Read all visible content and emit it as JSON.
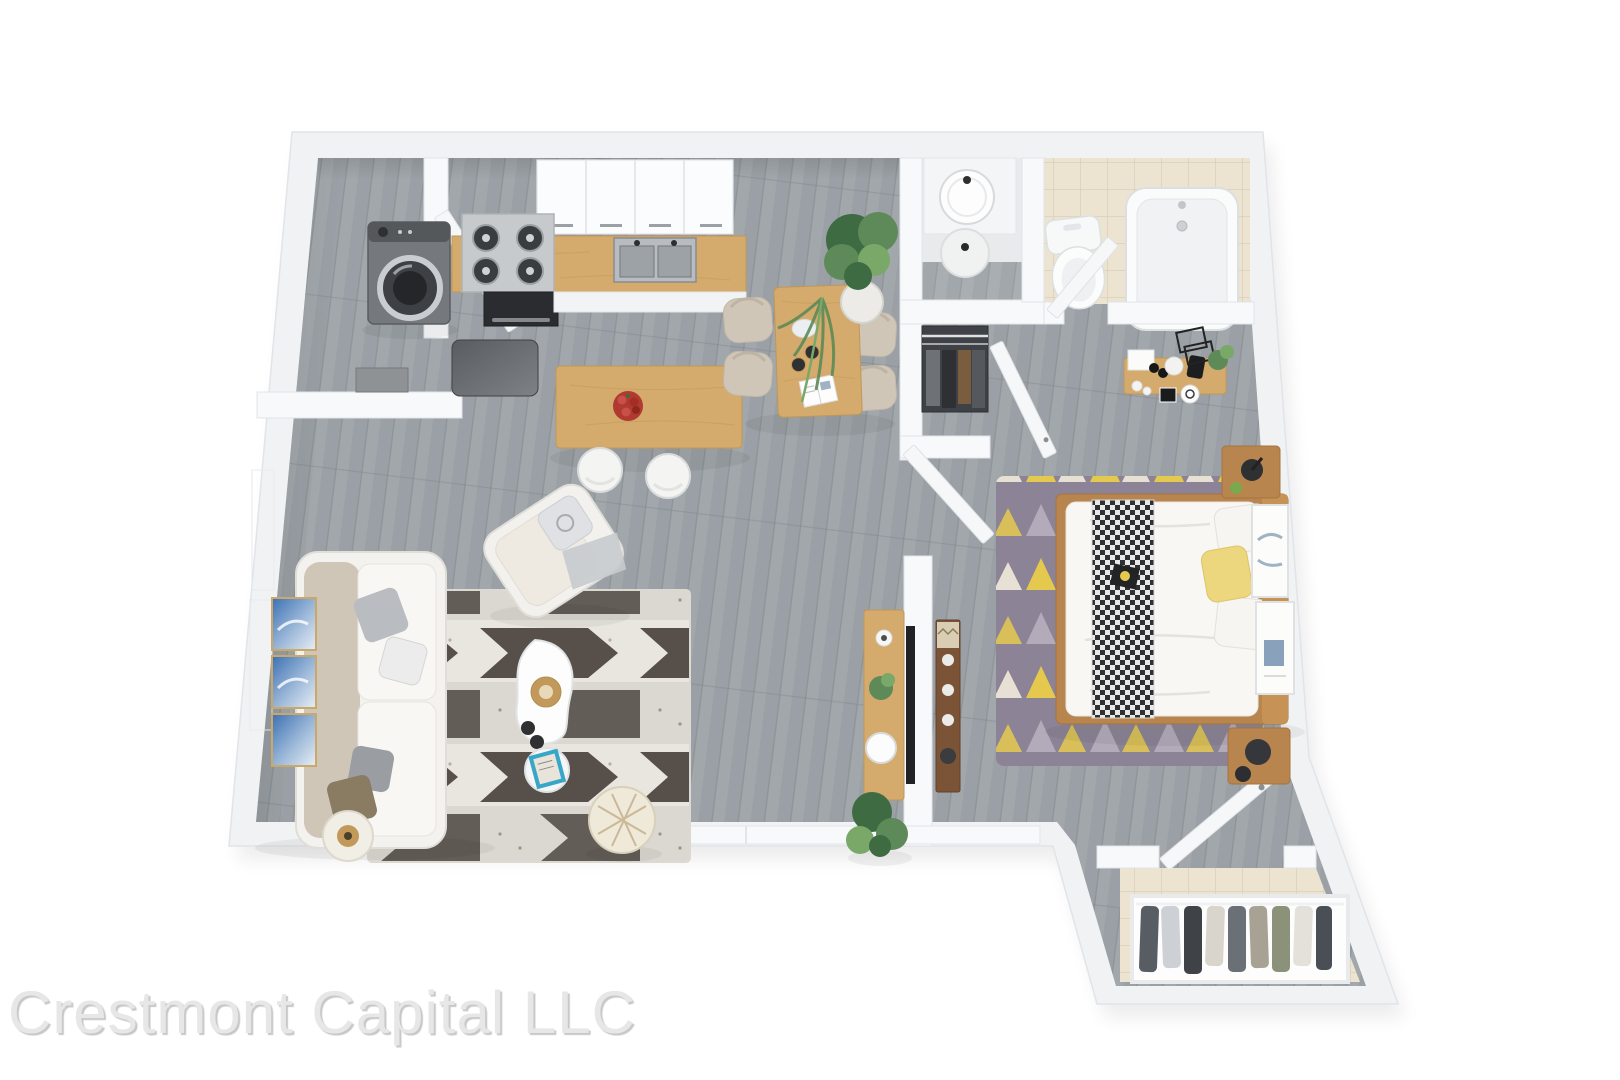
{
  "watermark": {
    "text": "Crestmont Capital LLC"
  },
  "palette": {
    "background": "#ffffff",
    "wall": "#f1f2f4",
    "wall_bright": "#f8f9fb",
    "wall_edge": "#e1e4e8",
    "floor_wood": "#9aa0a5",
    "floor_line": "#7e8489",
    "tile": "#ece4d1",
    "tile_line": "#d9cfba",
    "oak": "#d4ab6c",
    "oak_light": "#e0bf82",
    "oak_dark": "#b9854e",
    "walnut": "#7b5336",
    "steel": "#c6cacd",
    "steel_dark": "#2a2c2f",
    "beige": "#cfc6b8",
    "soft_white": "#f6f5f2",
    "rug_dark": "#57504a",
    "rug_mid": "#cfcbc4",
    "rug_light": "#e9e6e0",
    "bedrug_base": "#8c8496",
    "bedrug_yellow": "#e5c94f",
    "bedrug_purple": "#b3aaba",
    "bedrug_cream": "#e8e0d4",
    "green": "#5d8a58",
    "green_dark": "#3f6b42",
    "green_light": "#79a868",
    "red": "#b13a30",
    "blue": "#3c70b3",
    "gold": "#c2995a",
    "watermark": "#e7e7e7"
  },
  "plan": {
    "type": "3d-apartment-floor-plan",
    "rooms": [
      {
        "name": "kitchen",
        "fixtures": [
          "upper-cabinets",
          "stove",
          "oven",
          "kitchen-sink",
          "counter",
          "refrigerator",
          "kitchen-island",
          "fruit-bowl",
          "bar-stool",
          "bar-stool"
        ]
      },
      {
        "name": "laundry-closet",
        "fixtures": [
          "washing-machine",
          "laundry-cabinet",
          "laundry-door"
        ]
      },
      {
        "name": "dining-area",
        "fixtures": [
          "dining-table",
          "dining-chair",
          "dining-chair",
          "dining-chair",
          "dining-chair",
          "potted-plant",
          "palm-plant",
          "plate",
          "bowls",
          "magazine"
        ]
      },
      {
        "name": "bathroom",
        "fixtures": [
          "bathroom-sink",
          "vanity-platform",
          "round-stool",
          "toilet",
          "bathtub",
          "bathroom-door"
        ]
      },
      {
        "name": "hallway",
        "fixtures": [
          "hall-closet",
          "closet-door",
          "bedroom-door"
        ]
      },
      {
        "name": "bedroom",
        "fixtures": [
          "double-bed",
          "checkered-throw",
          "pillows",
          "nightstand",
          "nightstand",
          "bedroom-rug",
          "vanity-shelf",
          "wire-frames",
          "dresser",
          "leaning-frames",
          "entry-door"
        ]
      },
      {
        "name": "living-room",
        "fixtures": [
          "sofa",
          "armchair",
          "coffee-table",
          "side-table",
          "pouf",
          "floor-lamp",
          "wall-art",
          "living-rug",
          "tv-console",
          "tv",
          "potted-plant",
          "window"
        ]
      },
      {
        "name": "entry",
        "fixtures": [
          "open-wardrobe",
          "hanging-clothes"
        ]
      }
    ]
  }
}
